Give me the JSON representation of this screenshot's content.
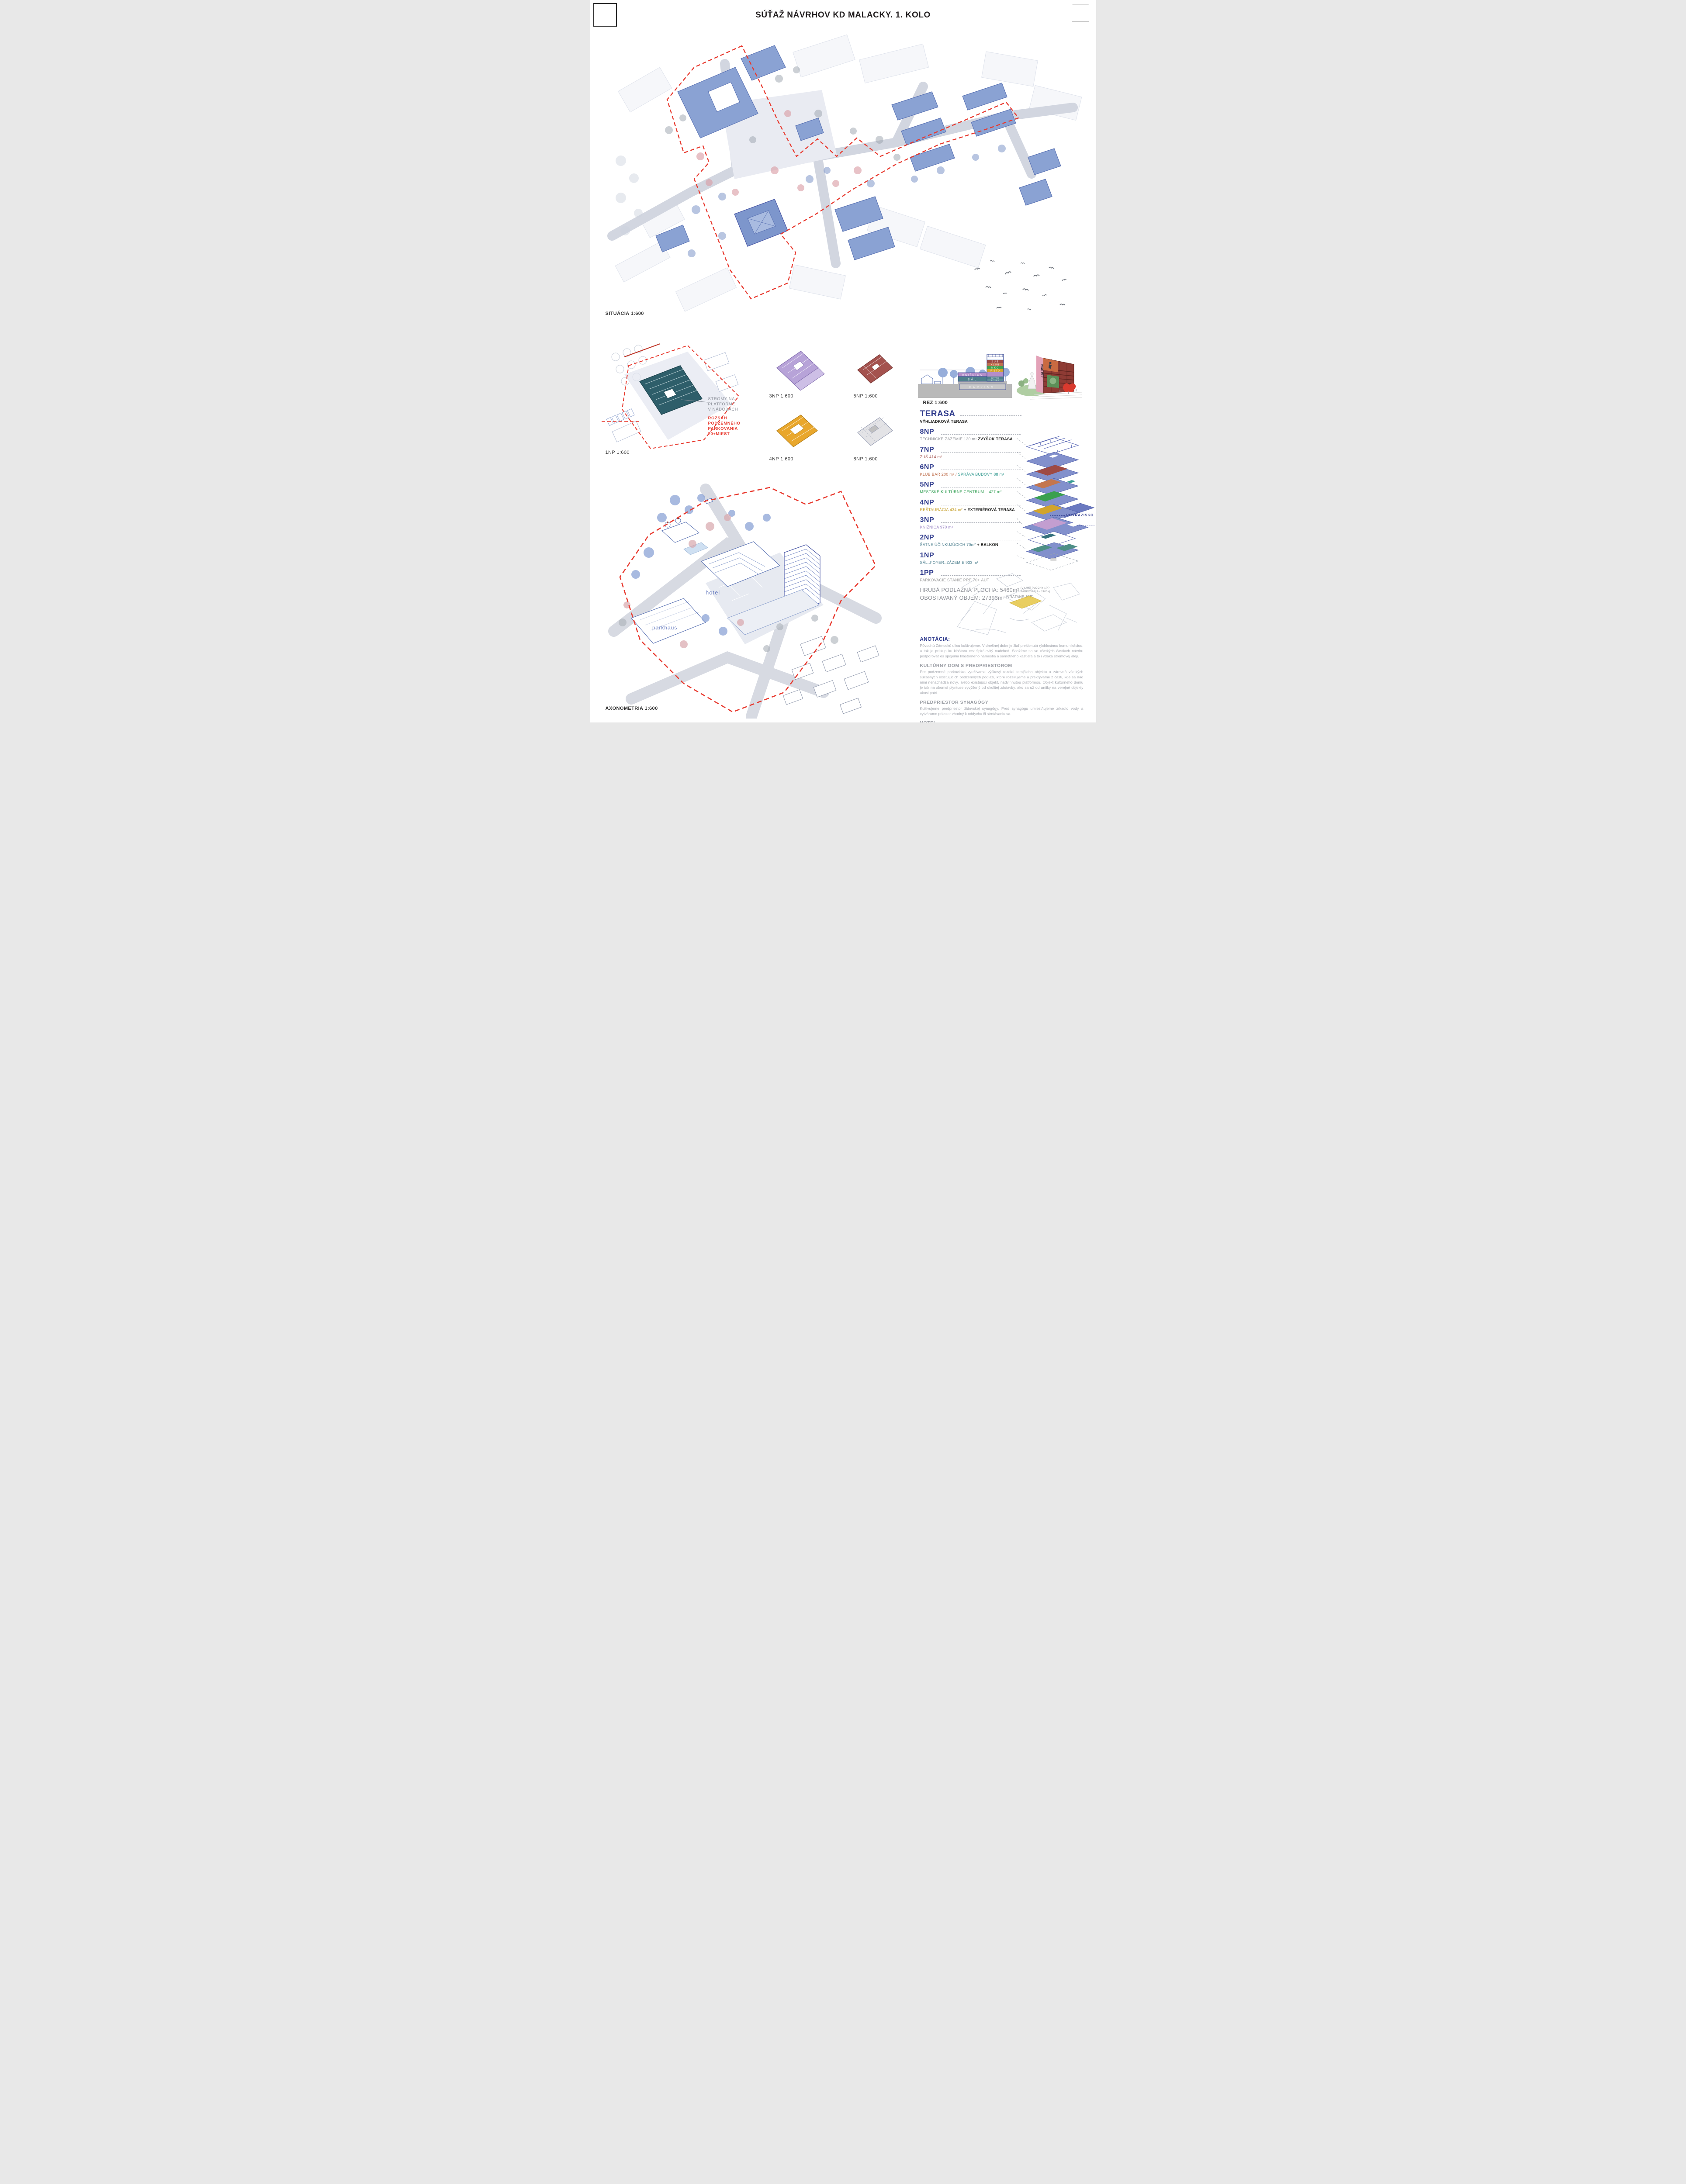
{
  "title": "SÚŤAŽ NÁVRHOV KD MALACKY. 1. KOLO",
  "drawing_labels": {
    "situacia": "SITUÁCIA 1:600",
    "np1": "1NP 1:600",
    "np3": "3NP 1:600",
    "np4": "4NP 1:600",
    "np5": "5NP 1:600",
    "np8": "8NP 1:600",
    "rez": "REZ 1:600",
    "axonometria": "AXONOMETRIA 1:600"
  },
  "site_plan_annotations": {
    "stromy_lines": [
      "STROMY NA",
      "PLATFORME",
      "V NÁDOBÁCH"
    ],
    "rozsah_lines": [
      "ROZSAH",
      "PODZEMNÉHO",
      "PARKOVANIA",
      "70+MIEST"
    ]
  },
  "axon_labels": {
    "hotel": "hotel",
    "parkhaus": "parkhaus"
  },
  "exploded_axon": {
    "povrazisko": "POVRAZISKO"
  },
  "render": {
    "banner_title": "Manet",
    "banner_subtitle": "and Modern Beauty"
  },
  "section_labels": {
    "t": "T",
    "zus": "ZUŠ",
    "klub": "KLUB",
    "mkc": "MKC",
    "risto": "RISTO",
    "kniznica": "KNIŽNICA",
    "satne": "ŠATNE",
    "foyer": "FOYER",
    "sal": "SÁL",
    "parking": "PARKING"
  },
  "program": {
    "items": [
      {
        "level": "TERASA",
        "parts": [
          {
            "text": "VÝHLIADKOVÁ TERASA",
            "color": "#1d1d1b",
            "bold": true
          }
        ]
      },
      {
        "level": "8NP",
        "parts": [
          {
            "text": "TECHNICKÉ ZÁZEMIE 120 m² ",
            "color": "#8f9196",
            "bold": false
          },
          {
            "text": "ZVYŠOK TERASA",
            "color": "#1d1d1b",
            "bold": true
          }
        ]
      },
      {
        "level": "7NP",
        "parts": [
          {
            "text": "ZUŠ 414 m²",
            "color": "#9e4a45",
            "bold": false
          }
        ]
      },
      {
        "level": "6NP",
        "parts": [
          {
            "text": "KLUB BAR 200 m² / ",
            "color": "#c0714f",
            "bold": false
          },
          {
            "text": "SPRÁVA BUDOVY 88 m²",
            "color": "#3a9d94",
            "bold": false
          }
        ]
      },
      {
        "level": "5NP",
        "parts": [
          {
            "text": "MESTSKÉ KULTÚRNE CENTRUM... 427 m²",
            "color": "#2f9e51",
            "bold": false
          }
        ]
      },
      {
        "level": "4NP",
        "parts": [
          {
            "text": "REŠTAURÁCIA 434 m² ",
            "color": "#c7a12e",
            "bold": false
          },
          {
            "text": "+ EXTERIÉROVÁ TERASA",
            "color": "#1d1d1b",
            "bold": true
          }
        ]
      },
      {
        "level": "3NP",
        "parts": [
          {
            "text": "KNIŽNICA 970 m²",
            "color": "#a08cc8",
            "bold": false
          }
        ]
      },
      {
        "level": "2NP",
        "parts": [
          {
            "text": "ŠATNE ÚČINKUJÚCICH 70m² ",
            "color": "#4d7f8e",
            "bold": false
          },
          {
            "text": "+ BALKON",
            "color": "#1d1d1b",
            "bold": true
          }
        ]
      },
      {
        "level": "1NP",
        "parts": [
          {
            "text": "SÁL..FOYER..ZÁZEMIE 933 m²",
            "color": "#4d7f8e",
            "bold": false
          }
        ]
      },
      {
        "level": "1PP",
        "parts": [
          {
            "text": "PARKOVACIE STÁNIE PRE 70+ ÁUT",
            "color": "#9d9d9d",
            "bold": false
          }
        ]
      }
    ],
    "totals": {
      "area_label": "HRUBÁ PODLAŽNÁ PLOCHA: 5460m²",
      "area_note_lines": [
        "(VYJMÄ PLOCHY 1PP",
        "PARKOVANIA - 2400+)"
      ],
      "volume_label": "OBOSTAVANÝ OBJEM: 27393m³",
      "volume_note": "(VRÁTANE 1PP)"
    }
  },
  "annotations": [
    {
      "heading": "ANOTÁCIA:",
      "body": "Pôvodnú Zámockú ulicu kultivujeme. V dnešnej dobe je žiaľ preklenutá rýchlostnou komunikáciou, a tak je prístup ku kláštoru cez špirálovitý nadchod. Snažíme sa vo všetkých častiach návrhu podporovať os spojenia kláštorného námestia a samotného kaštieľa a to i vdaka stromovej aleji."
    },
    {
      "heading": "KULTÚRNY DOM S PREDPRIESTOROM",
      "body": "Pre podzemné parkovisko využívame výškový rozdiel terajšieho objektu a zároveň všetkých súčasných existujúcich podzemných podlaží, ktoré rozširujeme a prekrývame z časti, kde sa nad nimi nenachádza nový, alebo existujúci objekt, nadvihnutou platformou. Objekt kultúrneho domu je tak na akomsi plyntuse vyvýšený od okolitej zástavby, ako sa už od antiky na verejné objekty akosi patrí."
    },
    {
      "heading": "PREDPRIESTOR SYNAGÓGY",
      "body": "Kultivujeme predpriestor židovskej synagógy. Pred synagógu umiestňujeme zrkadlo vody a vytvárame priestor vhodný k oddychu či stretávaniu sa."
    },
    {
      "heading": "HOTEL",
      "body": "V bezprostrednej blízkosti objektu kultúrneho domu sa nachádza objekt hotela, tento by snáď mohol v budúcnosti doznať zmien a zkultivovania formy, očistením od akýchsi jednopodlažných prílepkov naokolo. Hlavný vstup navrhujeme presunúť do priestoru na juh od objektu, ktorý kultivujeme vysadením stromov a premenou na verejný, nástupno spoločenský priestor a nie parkovisko."
    }
  ],
  "palette": {
    "accent_blue": "#2e3a8c",
    "boundary_red": "#e8392e",
    "building_blue": "#8aa2d3",
    "plan_teal": "#2e5e6a",
    "gray_text": "#8f9196"
  }
}
